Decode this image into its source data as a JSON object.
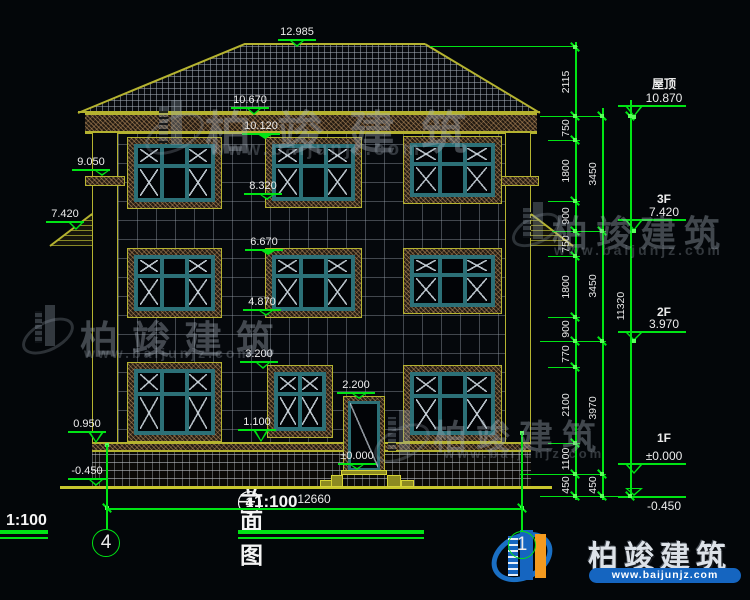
{
  "meta": {
    "drawing_type": "CAD building elevation"
  },
  "colors": {
    "background": "#030609",
    "cad_green": "#00e414",
    "cad_yellow": "#b5b330",
    "text_white": "#ececec",
    "window_teal": "#2c7077",
    "brand_blue": "#1565c0",
    "brand_orange": "#f49a1f"
  },
  "title": {
    "axis_start": "4",
    "axis_end": "1",
    "separator": "—",
    "name": "轴立面图",
    "scale": "1:100"
  },
  "corner_scale": {
    "scale": "1:100"
  },
  "overall_dim": {
    "value": "12660"
  },
  "axis_bubbles": {
    "left": "4",
    "right": "1"
  },
  "elevation_markers": {
    "center": [
      "12.985",
      "10.670",
      "10.120",
      "8.320",
      "6.670",
      "4.870",
      "3.200",
      "1.100"
    ],
    "door": [
      "2.200",
      "±0.000"
    ],
    "left": [
      "9.050",
      "7.420",
      "0.950",
      "-0.450"
    ]
  },
  "floor_labels": [
    {
      "label": "屋顶",
      "value": "10.870"
    },
    {
      "label": "3F",
      "value": "7.420"
    },
    {
      "label": "2F",
      "value": "3.970"
    },
    {
      "label": "1F",
      "value": "±0.000"
    },
    {
      "label": "",
      "value": "-0.450"
    }
  ],
  "dimension_chains": {
    "inner": [
      "2115",
      "750",
      "1800",
      "900",
      "750",
      "1800",
      "900",
      "770",
      "2100",
      "1100",
      "450"
    ],
    "middle": [
      "3450",
      "3450",
      "3970",
      "450"
    ],
    "outer": [
      "11320"
    ]
  },
  "watermark": {
    "name": "柏竣建筑",
    "url": "www.baijunjz.com"
  },
  "brand": {
    "name": "柏竣建筑",
    "url": "www.baijunjz.com"
  }
}
